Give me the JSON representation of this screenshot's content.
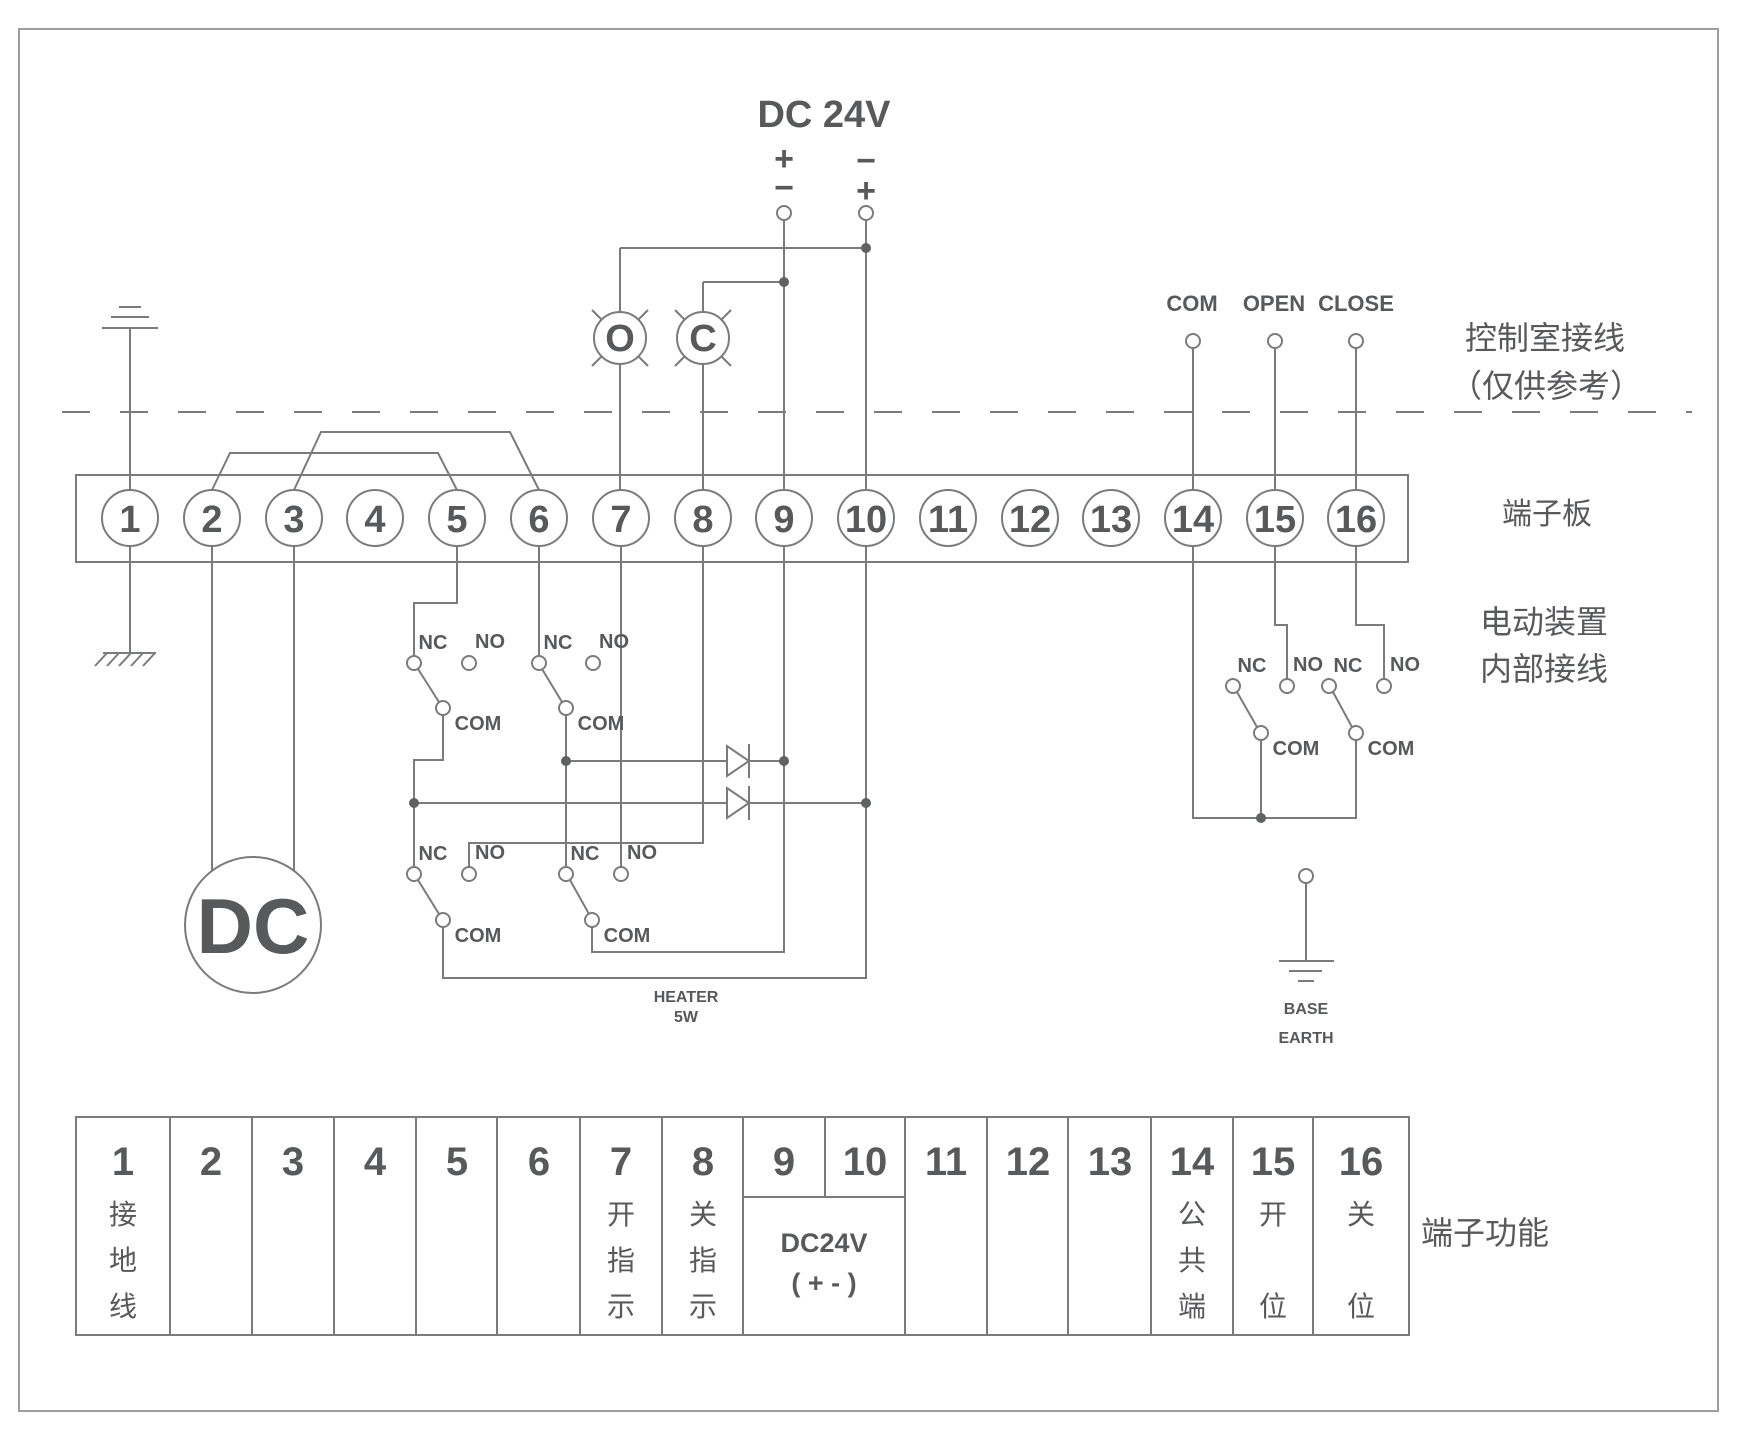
{
  "power": {
    "title": "DC 24V",
    "left_top": "+",
    "left_bottom": "−",
    "right_top": "−",
    "right_bottom": "+"
  },
  "lamps": {
    "open": "O",
    "close": "C"
  },
  "remote": {
    "com": "COM",
    "open": "OPEN",
    "close": "CLOSE"
  },
  "contacts": {
    "nc": "NC",
    "no": "NO",
    "com": "COM"
  },
  "motor_label": "DC",
  "heater": {
    "line1": "HEATER",
    "line2": "5W"
  },
  "base_earth": {
    "line1": "BASE",
    "line2": "EARTH"
  },
  "section_labels": {
    "control_room_line1": "控制室接线",
    "control_room_line2": "（仅供参考）",
    "terminal_board": "端子板",
    "internal_line1": "电动装置",
    "internal_line2": "内部接线",
    "table_label": "端子功能"
  },
  "terminals": [
    "1",
    "2",
    "3",
    "4",
    "5",
    "6",
    "7",
    "8",
    "9",
    "10",
    "11",
    "12",
    "13",
    "14",
    "15",
    "16"
  ],
  "table": {
    "functions": {
      "t1": [
        "接",
        "地",
        "线"
      ],
      "t7": [
        "开",
        "指",
        "示"
      ],
      "t8": [
        "关",
        "指",
        "示"
      ],
      "t14": [
        "公",
        "共",
        "端"
      ],
      "t15": [
        "开",
        "位"
      ],
      "t16": [
        "关",
        "位"
      ]
    },
    "dc_cell": {
      "line1": "DC24V",
      "line2": "( + - )"
    }
  },
  "colors": {
    "wire": "#797b7d",
    "text": "#58595b",
    "border": "#9b9da0"
  }
}
